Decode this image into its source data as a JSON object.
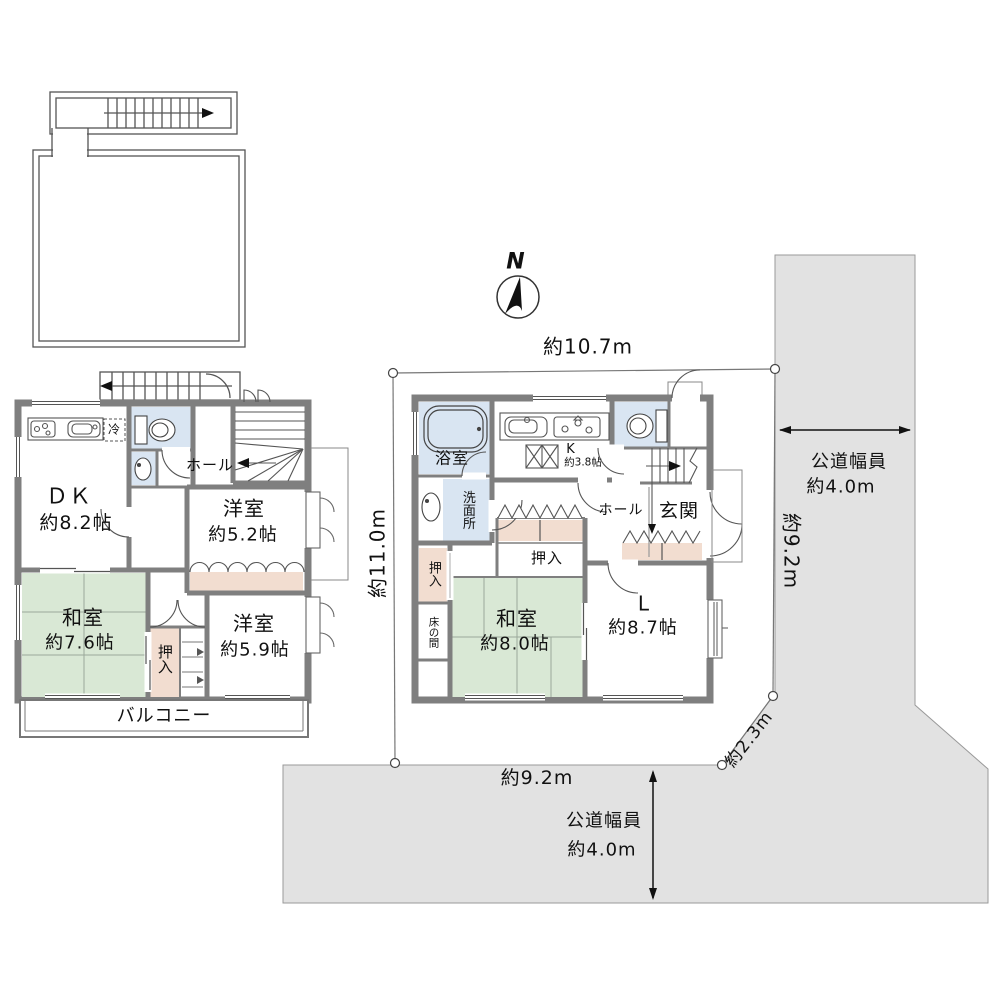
{
  "floor2": {
    "dk_name": "ＤＫ",
    "dk_size": "約8.2帖",
    "hall": "ホール",
    "fridge": "冷",
    "yoshitsu52_name": "洋室",
    "yoshitsu52_size": "約5.2帖",
    "washitsu_name": "和室",
    "washitsu_size": "約7.6帖",
    "oshiire": "押入",
    "yoshitsu59_name": "洋室",
    "yoshitsu59_size": "約5.9帖",
    "balcony": "バルコニー"
  },
  "floor1": {
    "bath": "浴室",
    "senmenjo": "洗面所",
    "k_name": "K",
    "k_size": "約3.8帖",
    "hall": "ホール",
    "genkan": "玄関",
    "oshiire_mid": "押入",
    "oshiire_left": "押入",
    "tokonoma": "床の間",
    "washitsu_name": "和室",
    "washitsu_size": "約8.0帖",
    "living_name": "L",
    "living_size": "約8.7帖"
  },
  "dimensions": {
    "top": "約10.7m",
    "left": "約11.0m",
    "right": "約9.2m",
    "corner": "約2.3m",
    "bottom": "約9.2m"
  },
  "roads": {
    "right_name": "公道幅員",
    "right_width": "約4.0m",
    "bottom_name": "公道幅員",
    "bottom_width": "約4.0m"
  },
  "compass": {
    "north": "N"
  },
  "colors": {
    "wall": "#7f7f7f",
    "tatami": "#d9e8d5",
    "closet": "#f2ddd0",
    "wet_area": "#d9e5f2",
    "road": "#e2e2e2"
  }
}
